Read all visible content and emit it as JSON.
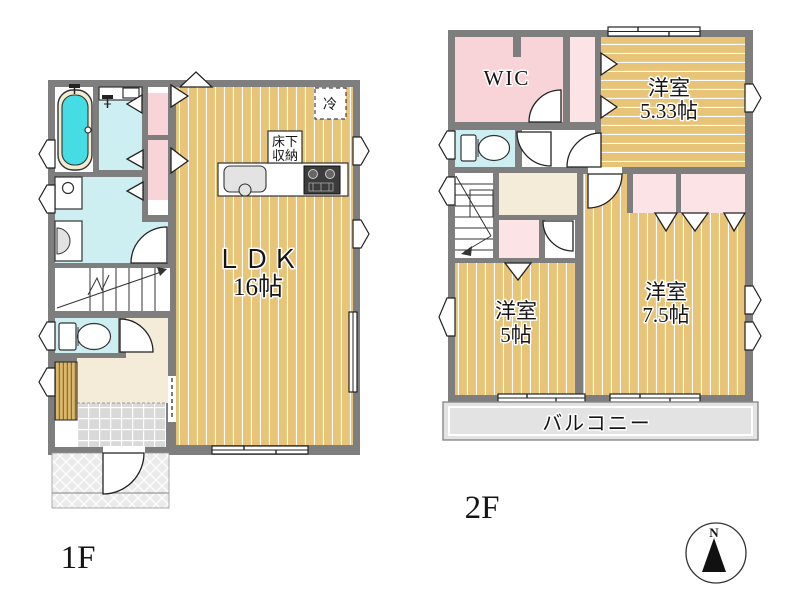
{
  "floor1": {
    "label": "1F",
    "ldk_name": "ＬＤＫ",
    "ldk_size": "16帖",
    "fridge": "冷",
    "storage_line1": "床下",
    "storage_line2": "収納"
  },
  "floor2": {
    "label": "2F",
    "wic": "WIC",
    "room533_name": "洋室",
    "room533_size": "5.33帖",
    "room5_name": "洋室",
    "room5_size": "5帖",
    "room75_name": "洋室",
    "room75_size": "7.5帖",
    "balcony": "バルコニー"
  },
  "compass": {
    "north": "N"
  },
  "colors": {
    "wall": "#7E7E7E",
    "wood": "#E8C478",
    "water": "#CDEFF2",
    "tub": "#45DCE4",
    "tubrim": "#F2ECD2",
    "pink": "#F8D4D9",
    "pinklight": "#FBE3E6",
    "beige": "#F4ECD8",
    "balcony": "#E3E3E3",
    "tile": "#D9D9D9",
    "porch": "#EBEBEB",
    "shoe": "#DBB76C",
    "stove": "#3C3C3C"
  }
}
